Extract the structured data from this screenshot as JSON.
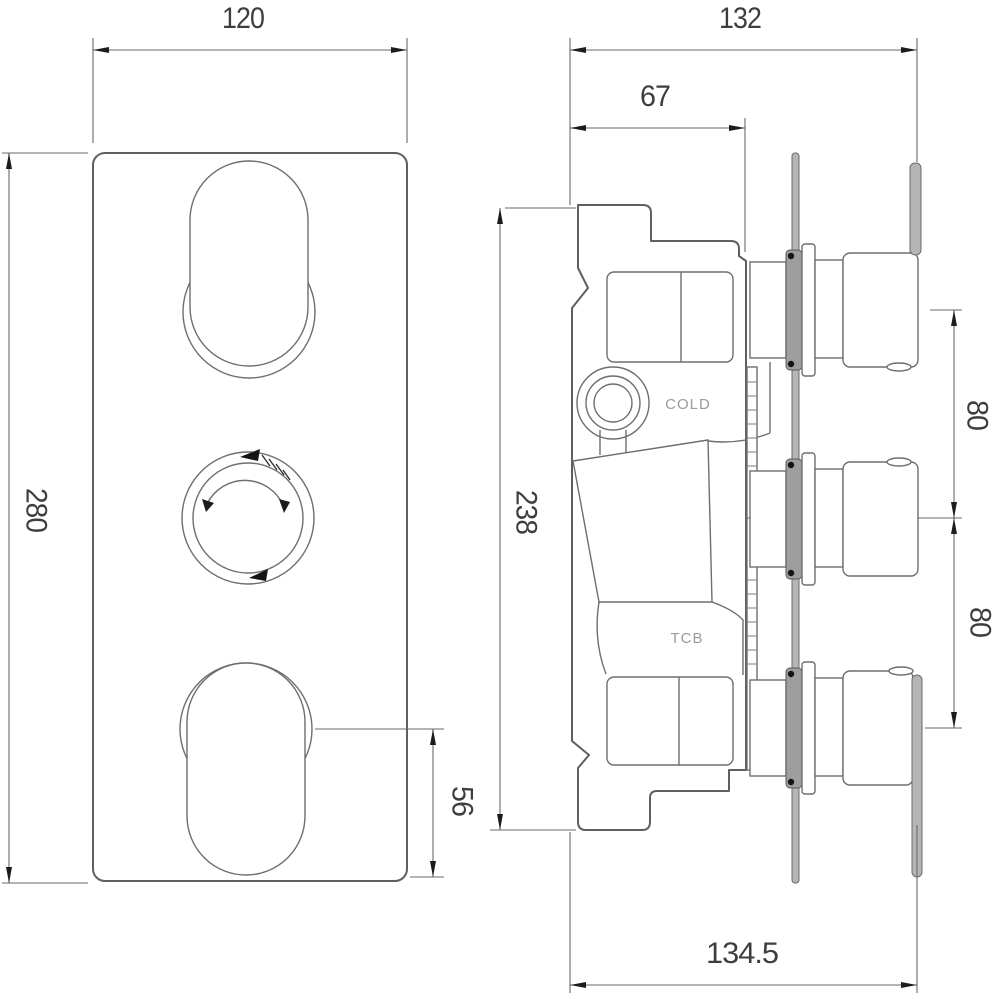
{
  "drawing": {
    "title": "Thermostatic shower valve technical drawing, front and side views",
    "colors": {
      "background": "#ffffff",
      "outline": "#5f5f5f",
      "dimension": "#6a6a6a",
      "text": "#3e3e3e",
      "port_label": "#9b9b9b",
      "metal_fill": "#b5b5b5",
      "arrow_black": "#1c1c1c"
    },
    "front_view": {
      "dims": {
        "plate_width": "120",
        "plate_height": "280",
        "knob_to_bottom": "56"
      }
    },
    "side_view": {
      "dims": {
        "depth_overall": "132",
        "body_depth": "67",
        "body_height": "238",
        "handle_spacing_upper": "80",
        "handle_spacing_lower": "80",
        "total_projection": "134.5"
      },
      "labels": {
        "cold_port": "COLD",
        "tcb_port": "TCB"
      }
    }
  }
}
